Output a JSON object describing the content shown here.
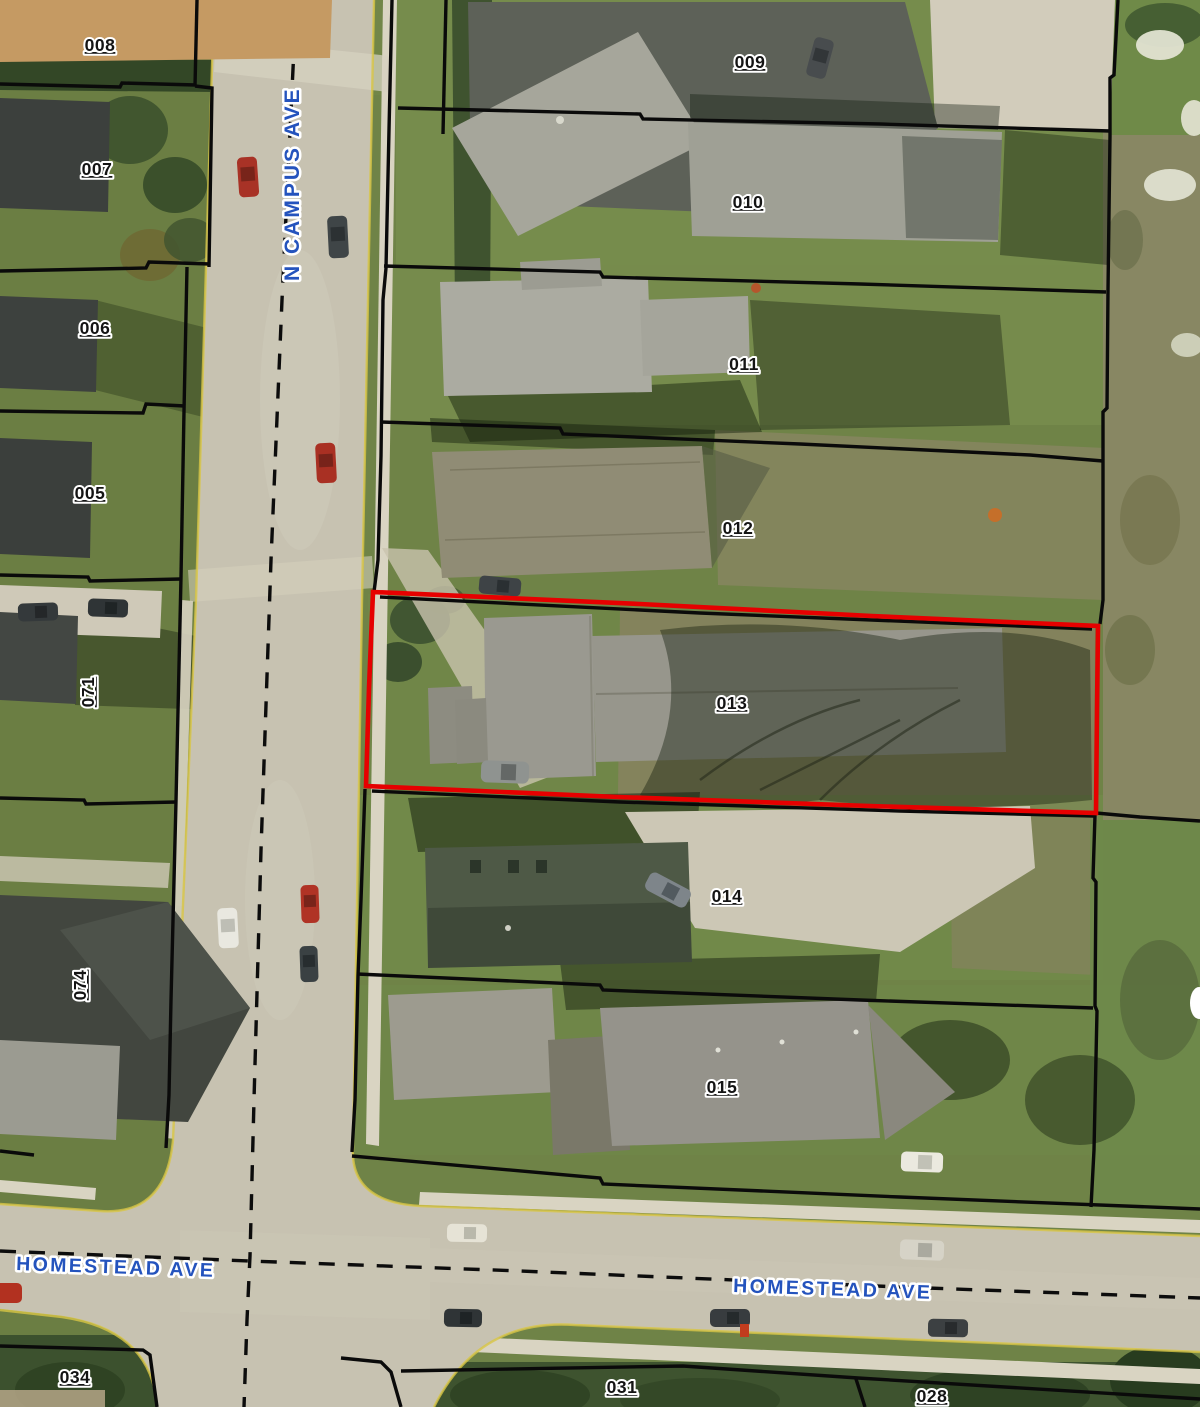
{
  "map": {
    "title": "Aerial parcel map with highlighted lot",
    "street_labels": [
      {
        "text": "N CAMPUS AVE"
      },
      {
        "text": "HOMESTEAD AVE"
      },
      {
        "text": "HOMESTEAD AVE"
      }
    ],
    "parcel_labels": [
      {
        "label": "008"
      },
      {
        "label": "007"
      },
      {
        "label": "006"
      },
      {
        "label": "005"
      },
      {
        "label": "071"
      },
      {
        "label": "074"
      },
      {
        "label": "034"
      },
      {
        "label": "009"
      },
      {
        "label": "010"
      },
      {
        "label": "011"
      },
      {
        "label": "012"
      },
      {
        "label": "013"
      },
      {
        "label": "014"
      },
      {
        "label": "015"
      },
      {
        "label": "031"
      },
      {
        "label": "028"
      }
    ],
    "highlighted_parcel": {
      "id": "013",
      "outline_color": "#e60000"
    },
    "colors": {
      "parcel_boundary": "#0a0a0a",
      "street_centerline": "#0c0c0c",
      "street_label": "#2453bd",
      "parcel_label": "#141414",
      "label_halo": "#ffffff",
      "highlight_outline": "#e60000",
      "pavement": "#c7c2b1",
      "grass": "#6f8347"
    }
  }
}
